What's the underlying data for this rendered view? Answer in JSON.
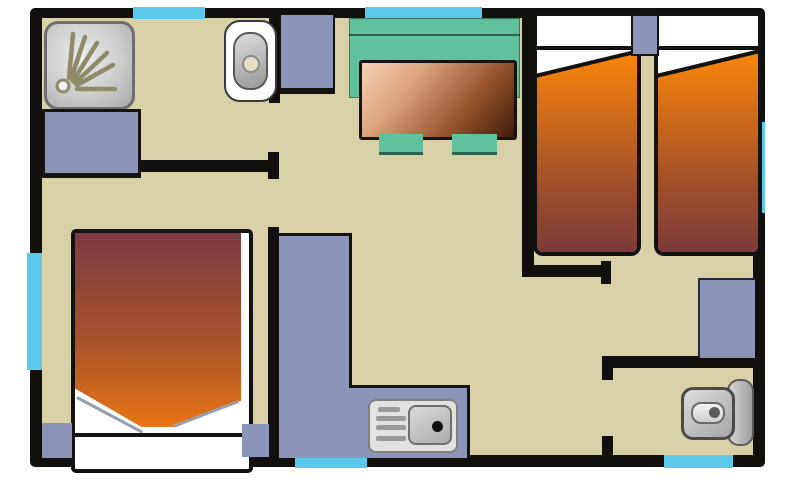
{
  "title": "Mobile home floor plan (top view)",
  "colors": {
    "floor": "#D8D1A7",
    "wall": "#12100D",
    "window": "#5BC8EC",
    "unit": "#8C95B9",
    "bench": "#60C29D",
    "tableLight": "#F6D0B8",
    "tableDark": "#3F1B08",
    "bedOrange": "#F5820D",
    "bedMaroon": "#7C3A3A",
    "dblMaroon": "#7C3A42",
    "dblOrange": "#EF7710",
    "spray": "#8F8A68"
  },
  "window_strips": 6,
  "rooms": [
    {
      "name": "bathroom",
      "furniture": [
        "shower",
        "washbasin",
        "cabinet"
      ]
    },
    {
      "name": "living-dining",
      "furniture": [
        "storage-cabinet",
        "bench-seat",
        "dining-table",
        "stool",
        "stool"
      ]
    },
    {
      "name": "twin-bedroom",
      "furniture": [
        "single-bed",
        "single-bed",
        "bedside-table",
        "nightstand"
      ]
    },
    {
      "name": "double-bedroom",
      "furniture": [
        "double-bed",
        "nightstand",
        "nightstand"
      ]
    },
    {
      "name": "kitchen",
      "furniture": [
        "l-shaped-counter",
        "sink-with-drainboard"
      ]
    },
    {
      "name": "wc",
      "furniture": [
        "toilet"
      ]
    }
  ]
}
